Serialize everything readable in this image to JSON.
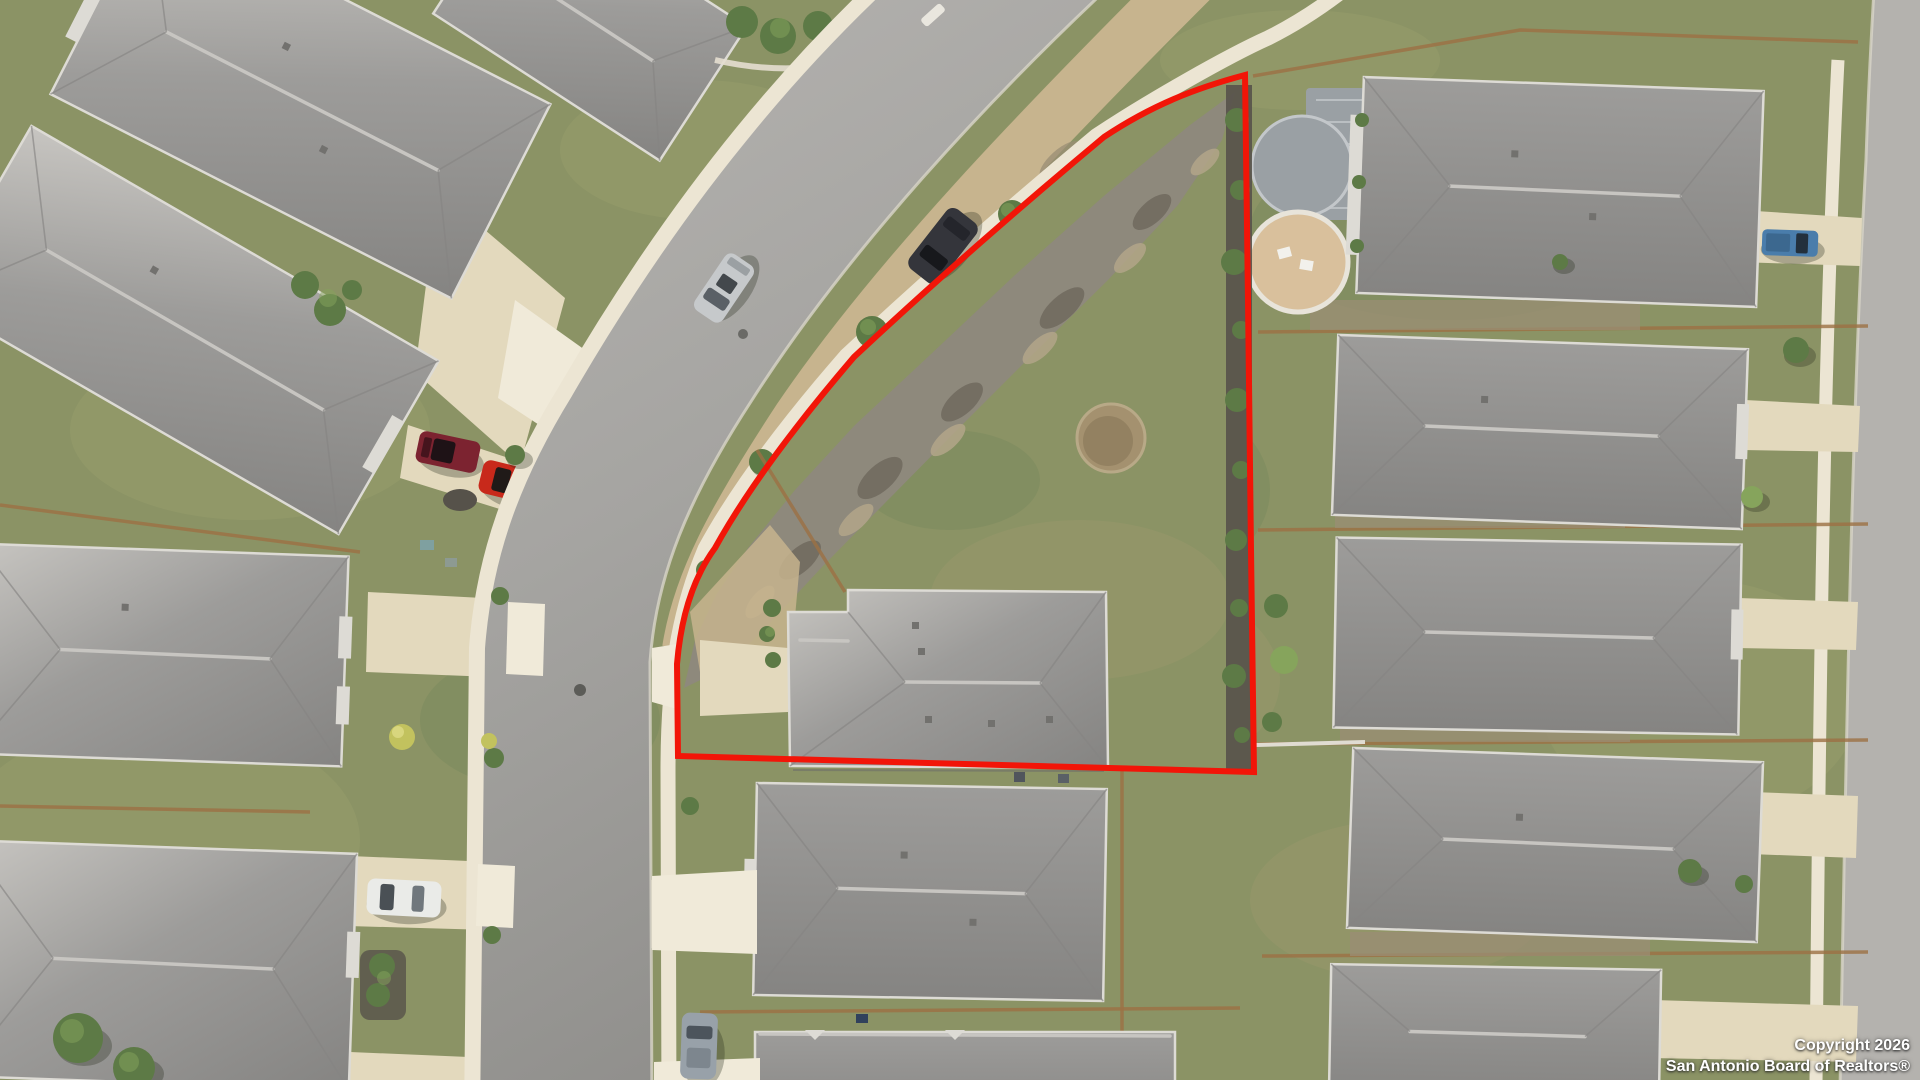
{
  "scene": {
    "type": "aerial-drone-photo",
    "description": "Overhead view of a suburban neighborhood; a corner lot with a house is outlined in red along a curving street."
  },
  "watermark": {
    "line1": "Copyright 2026",
    "line2": "San Antonio Board of Realtors®"
  },
  "colors": {
    "boundary": "#f21508",
    "road_light": "#b7b5b2",
    "road": "#a5a4a1",
    "road_dark": "#8e8d8a",
    "street_right": "#b4b2ae",
    "sidewalk": "#ece5d3",
    "apron": "#f0ead9",
    "driveway": "#e3d9bd",
    "lawn": "#8b9365",
    "lawn_light": "#a0a671",
    "lawn_dark": "#70855a",
    "roof": "#9d9c9a",
    "roof_dark": "#858482",
    "roof_light": "#c7c5c1",
    "eave": "#dddbd5",
    "dirt": "#c7b48e",
    "dirt_dark": "#9a8d74",
    "brush": "#8e897c",
    "brush_dark": "#6f695e",
    "mulch": "#56524a",
    "sand": "#d9c09c",
    "paver": "#9aa0a4",
    "tree": "#5d7a46",
    "tree_light": "#86a45c",
    "yellow_shrub": "#c2c25e",
    "fence": "#9c7144",
    "car_red": "#c8291b",
    "car_maroon": "#7c2330",
    "car_silver": "#c6c9cb",
    "car_dark": "#34353b",
    "car_white": "#eaebe8",
    "car_blue": "#4a7dab",
    "car_gray": "#98a1a9",
    "shadow": "rgba(35,42,28,0.30)"
  }
}
